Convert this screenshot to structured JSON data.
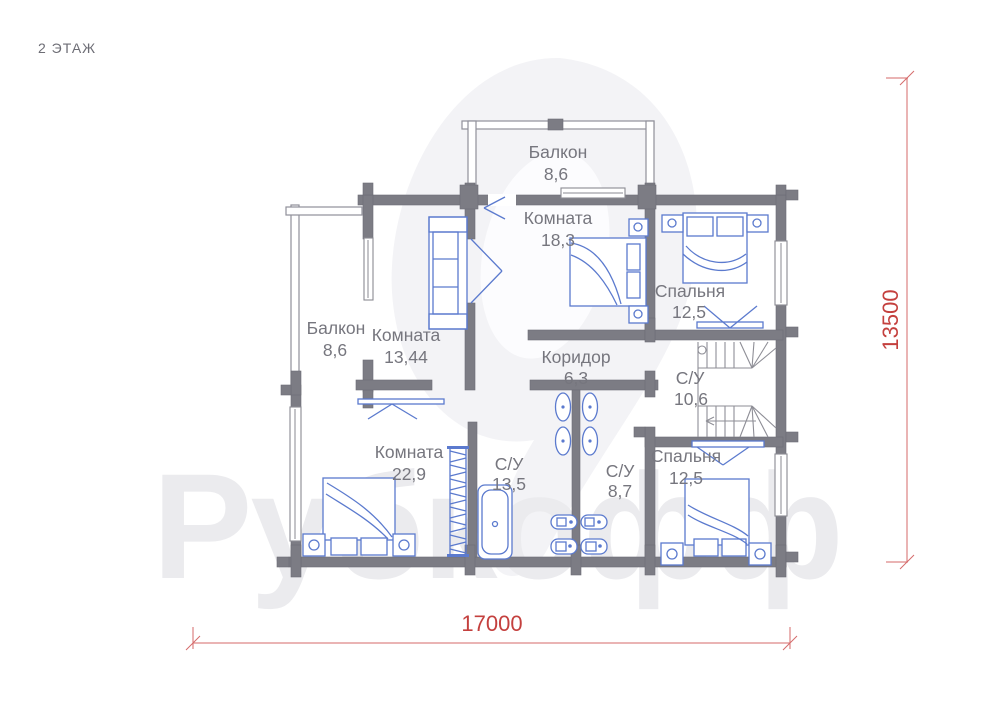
{
  "title": "2 ЭТАЖ",
  "watermark": "Рубкофф",
  "colors": {
    "wall": "#7c7c84",
    "furniture": "#5b7ace",
    "label": "#76767e",
    "dimension": "#c4403e",
    "watermark": "#ebebee"
  },
  "rooms": [
    {
      "name": "Балкон",
      "area": "8,6"
    },
    {
      "name": "Комната",
      "area": "18,3"
    },
    {
      "name": "Спальня",
      "area": "12,5"
    },
    {
      "name": "Балкон",
      "area": "8,6"
    },
    {
      "name": "Комната",
      "area": "13,44"
    },
    {
      "name": "Коридор",
      "area": "6,3"
    },
    {
      "name": "С/У",
      "area": "10,6"
    },
    {
      "name": "Комната",
      "area": "22,9"
    },
    {
      "name": "С/У",
      "area": "13,5"
    },
    {
      "name": "С/У",
      "area": "8,7"
    },
    {
      "name": "Спальня",
      "area": "12,5"
    }
  ],
  "dimensions": {
    "width_label": "17000",
    "height_label": "13500"
  }
}
